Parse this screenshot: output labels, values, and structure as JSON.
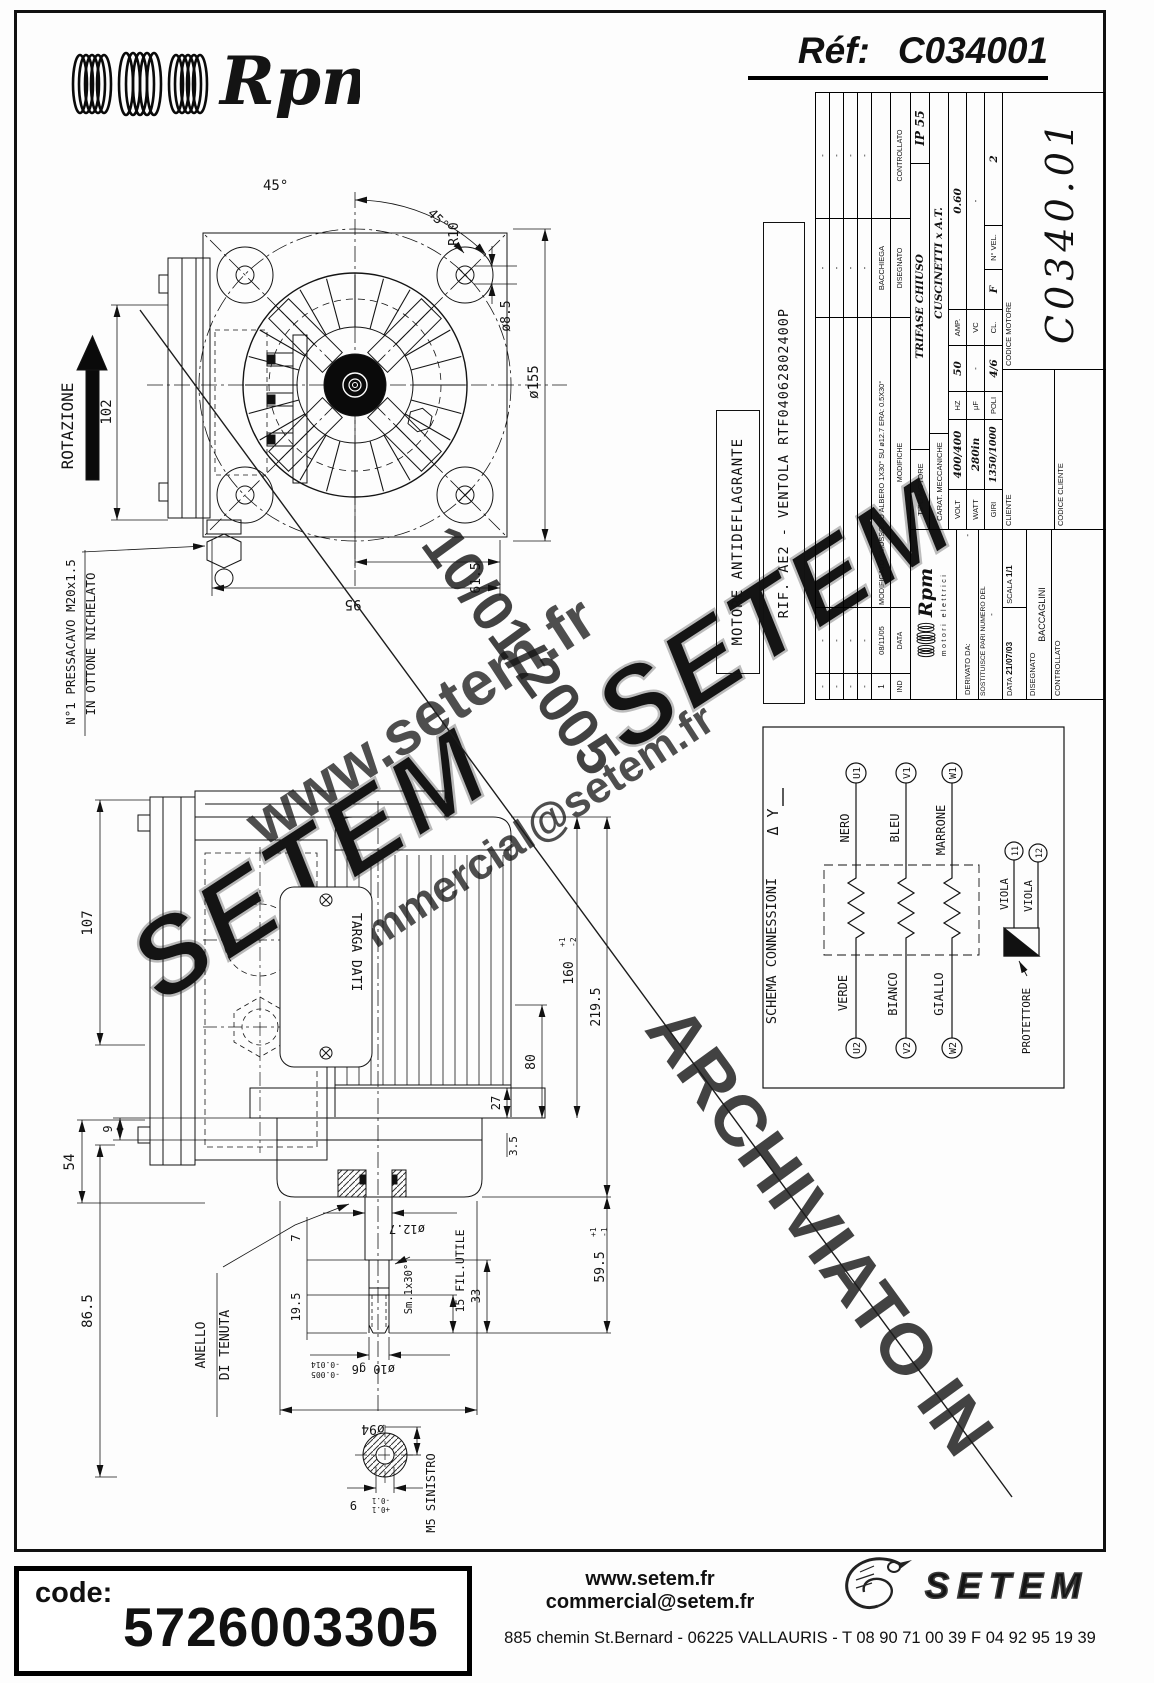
{
  "page": {
    "logo_script": "Rpm",
    "ref_label": "Réf:",
    "ref_value": "C034001"
  },
  "watermarks": {
    "site": "www.setem.fr",
    "email": "commercial@setem.fr",
    "brand1": "SETEM",
    "brand2": "SETEM",
    "date": "10/01/2005",
    "archived": "ARCHIVIATO IN"
  },
  "labels": {
    "motore_box": "MOTORE ANTIDEFLAGRANTE",
    "rif_box": "RIF. AE2 - VENTOLA RTF04062802400P"
  },
  "front_view": {
    "rotation": "ROTAZIONE",
    "angle1": "45°",
    "angle2": "45°",
    "radius": "R10",
    "hole_dia": "ø8.5",
    "outer_dia": "ø155",
    "dim_height": "102",
    "dim_width": "95",
    "dim_offset": "61.5",
    "gland_note_1": "N°1 PRESSACAVO M20x1.5",
    "gland_note_2": "IN OTTONE NICHELATO"
  },
  "side_view": {
    "dim_107": "107",
    "dim_54": "54",
    "dim_9": "9",
    "dim_86_5": "86.5",
    "seal_1": "ANELLO",
    "seal_2": "DI TENUTA",
    "plate": "TARGA DATI",
    "dim_27": "27",
    "dim_3_5": "3.5",
    "dim_80": "80",
    "dim_160": "160",
    "dim_160_tol_p": "+1",
    "dim_160_tol_m": "-2",
    "dim_219_5": "219.5",
    "dim_59_5": "59.5",
    "dim_59_tol_p": "+1",
    "dim_59_tol_m": "-1",
    "shaft_dia": "ø12.7",
    "dim_7": "7",
    "dim_19_5": "19.5",
    "chamfer": "Sm.1x30°",
    "thread_len": "15 FIL.UTILE",
    "dim_33": "33",
    "end_dia": "ø10 g6",
    "end_tol_1": "-0.005",
    "end_tol_2": "-0.014",
    "flange_dia": "ø94",
    "thread_note": "M5 SINISTRO",
    "dim_9b": "9",
    "dim_9b_tol_p": "+0.1",
    "dim_9b_tol_m": "-0.1"
  },
  "schema": {
    "title": "SCHEMA CONNESSIONI",
    "symbols": "Δ Y",
    "u1": "U1",
    "v1": "V1",
    "w1": "W1",
    "u2": "U2",
    "v2": "V2",
    "w2": "W2",
    "c_u1": "NERO",
    "c_v1": "BLEU",
    "c_w1": "MARRONE",
    "c_u2": "VERDE",
    "c_v2": "BIANCO",
    "c_w2": "GIALLO",
    "viola1": "VIOLA",
    "viola2": "VIOLA",
    "t11": "11",
    "t12": "12",
    "protector": "PROTETTORE"
  },
  "title_block": {
    "rev_header": {
      "ind": "IND",
      "data": "DATA",
      "mod": "MODIFICHE",
      "dis": "DISEGNATO",
      "ctrl": "CONTROLLATO"
    },
    "rev_rows": [
      {
        "ind": "-",
        "data": "-",
        "mod": "",
        "dis": "-",
        "ctrl": "-"
      },
      {
        "ind": "-",
        "data": "-",
        "mod": "",
        "dis": "-",
        "ctrl": "-"
      },
      {
        "ind": "-",
        "data": "-",
        "mod": "",
        "dis": "-",
        "ctrl": "-"
      },
      {
        "ind": "-",
        "data": "-",
        "mod": "",
        "dis": "-",
        "ctrl": "-"
      },
      {
        "ind": "1",
        "data": "08/11/05",
        "mod": "MODIFICATO SMUSSO SU ALBERO 1X30° SU ø12.7 ERA: 0.5X30°",
        "dis": "BACCHIEGA",
        "ctrl": ""
      }
    ],
    "ip": "IP 55",
    "tipo_label": "TIPO MOTORE",
    "tipo": "TRIFASE CHIUSO",
    "carat_label": "CARAT. MECCANICHE",
    "carat": "CUSCINETTI x A.T.",
    "volt_label": "VOLT",
    "volt": "400/400",
    "hz_label": "HZ",
    "hz": "50",
    "amp_label": "AMP.",
    "amp": "0.60",
    "watt_label": "WATT",
    "watt": "280in",
    "uf_label": "µF",
    "uf": "-",
    "vc_label": "VC",
    "vc": "-",
    "giri_label": "GIRI",
    "giri": "1350/1000",
    "poli_label": "POLI",
    "poli": "4/6",
    "cl_label": "CL.",
    "cl": "F",
    "nvel_label": "N° VEL.",
    "nvel": "2",
    "logo_script": "Rpm",
    "logo_sub": "motori elettrici",
    "derivato_label": "DERIVATO DA:",
    "derivato": "-",
    "sostituisce_label": "SOSTITUISCE PARI NUMERO DEL",
    "sostituisce": "-",
    "data_label": "DATA",
    "data": "21/07/03",
    "scala_label": "SCALA",
    "scala": "1/1",
    "disegnato_label": "DISEGNATO",
    "disegnato": "BACCAGLINI",
    "controllato_label": "CONTROLLATO",
    "cliente_label": "CLIENTE",
    "codice_cliente_label": "CODICE CLIENTE",
    "codice_motore_label": "CODICE MOTORE",
    "codice_motore": "C0340.01"
  },
  "footer": {
    "code_label": "code:",
    "code": "5726003305",
    "site": "www.setem.fr",
    "email": "commercial@setem.fr",
    "brand": "SETEM",
    "address": "885 chemin St.Bernard  -  06225 VALLAURIS  -  T 08 90 71 00 39   F 04 92 95 19 39"
  }
}
